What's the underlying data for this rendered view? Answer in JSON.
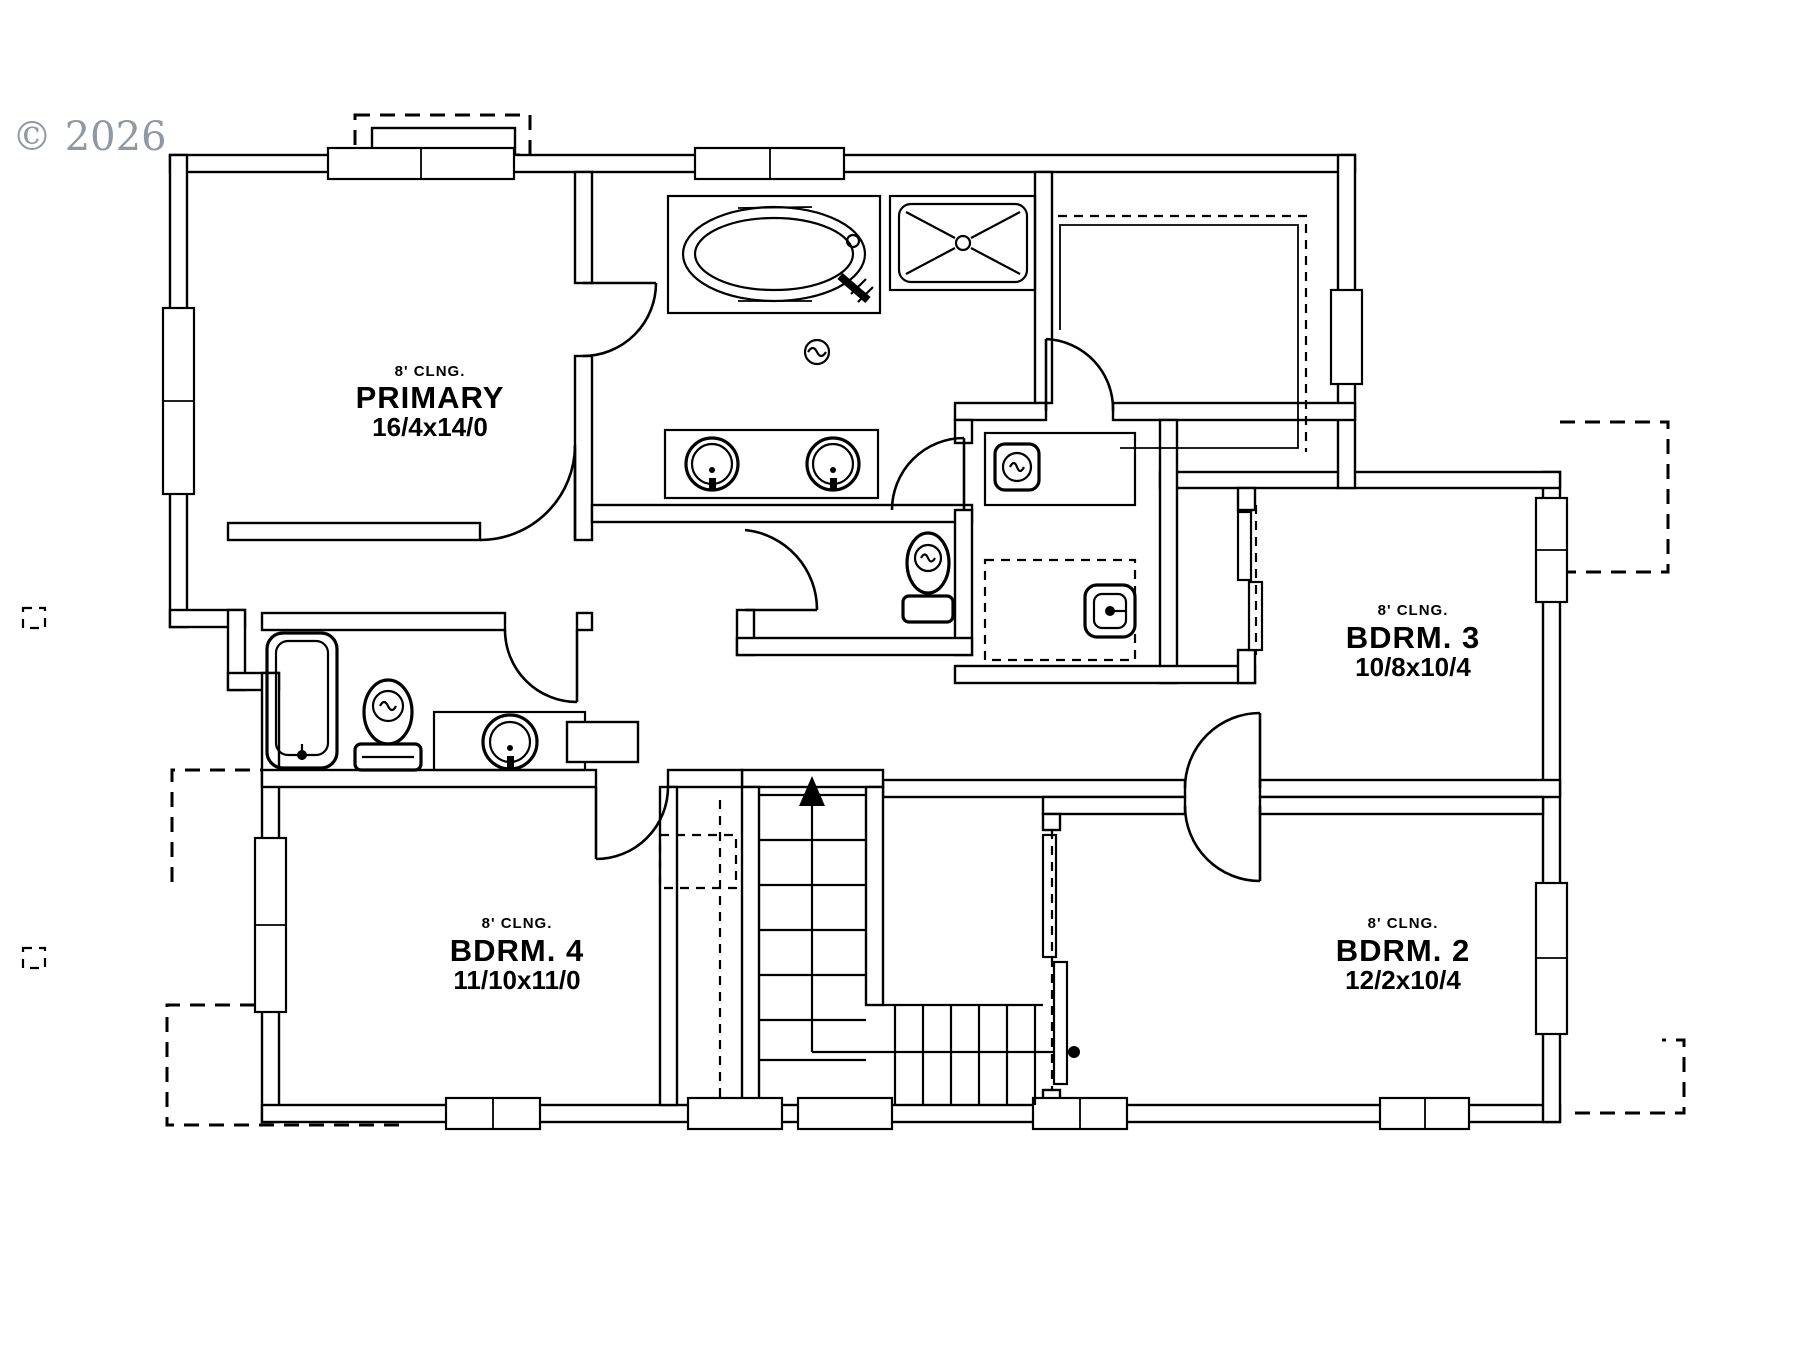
{
  "watermark": "© 2026",
  "rooms": [
    {
      "id": "primary",
      "ceiling": "8' CLNG.",
      "name": "PRIMARY",
      "dims": "16/4x14/0"
    },
    {
      "id": "bdrm3",
      "ceiling": "8' CLNG.",
      "name": "BDRM. 3",
      "dims": "10/8x10/4"
    },
    {
      "id": "bdrm4",
      "ceiling": "8' CLNG.",
      "name": "BDRM. 4",
      "dims": "11/10x11/0"
    },
    {
      "id": "bdrm2",
      "ceiling": "8' CLNG.",
      "name": "BDRM. 2",
      "dims": "12/2x10/4"
    }
  ],
  "fixtures": [
    "soaking-tub",
    "walk-in-shower",
    "double-vanity-sinks",
    "floor-drain",
    "water-closet-toilet",
    "hall-bath-tub",
    "hall-bath-toilet",
    "hall-bath-sink",
    "washer",
    "dryer",
    "stairs-up",
    "walk-in-closet",
    "linen-closet",
    "sliding-closet-doors",
    "deck-outline-below",
    "deck-posts"
  ],
  "colors": {
    "line": "#000000",
    "watermark": "#8f99a4",
    "background": "#ffffff"
  }
}
